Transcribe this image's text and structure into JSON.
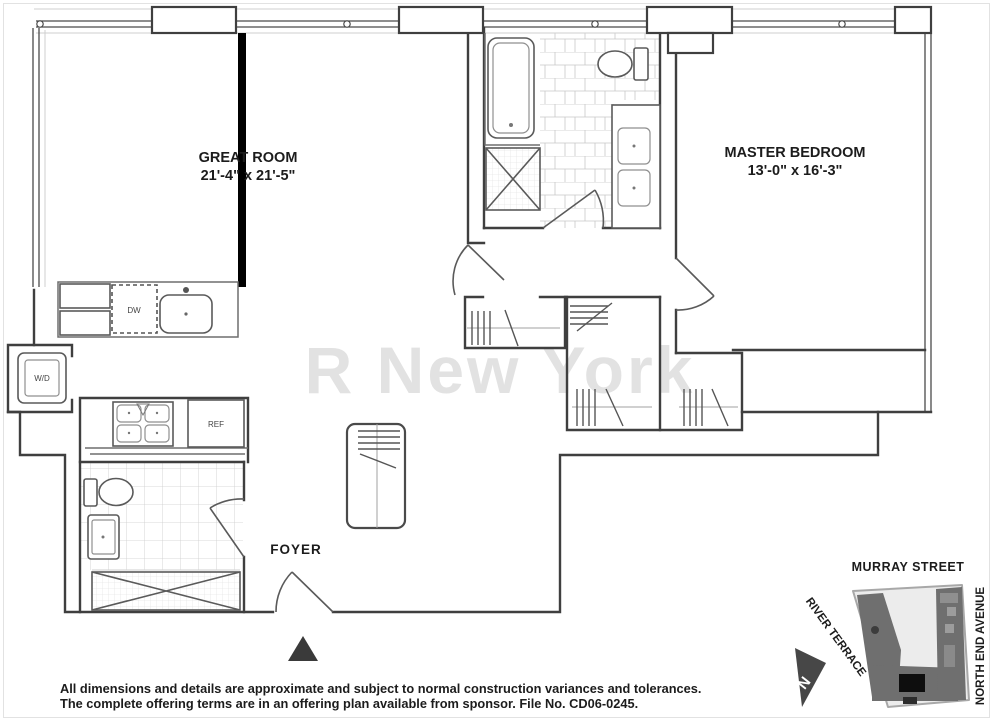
{
  "labels": {
    "great_room": {
      "name": "GREAT ROOM",
      "dims": "21'-4\" x 21'-5\""
    },
    "master_bedroom": {
      "name": "MASTER BEDROOM",
      "dims": "13'-0\" x 16'-3\""
    },
    "foyer": "FOYER",
    "dw": "DW",
    "wd": "W/D",
    "ref": "REF"
  },
  "watermark": "R New York",
  "disclaimer": {
    "line1": "All dimensions and details are approximate and subject to normal construction variances and tolerances.",
    "line2": "The complete offering terms are in an offering plan available from sponsor. File No. CD06-0245."
  },
  "map": {
    "murray": "MURRAY STREET",
    "river": "RIVER TERRACE",
    "north_end": "NORTH END AVENUE",
    "north": "N"
  },
  "colors": {
    "wall": "#3f3f3f",
    "highlight_wall": "#000000",
    "watermark": "#e2e2e2",
    "map_plot": "#ececec",
    "map_footprint": "#6f6f6f",
    "map_unit": "#0e0e0e"
  }
}
